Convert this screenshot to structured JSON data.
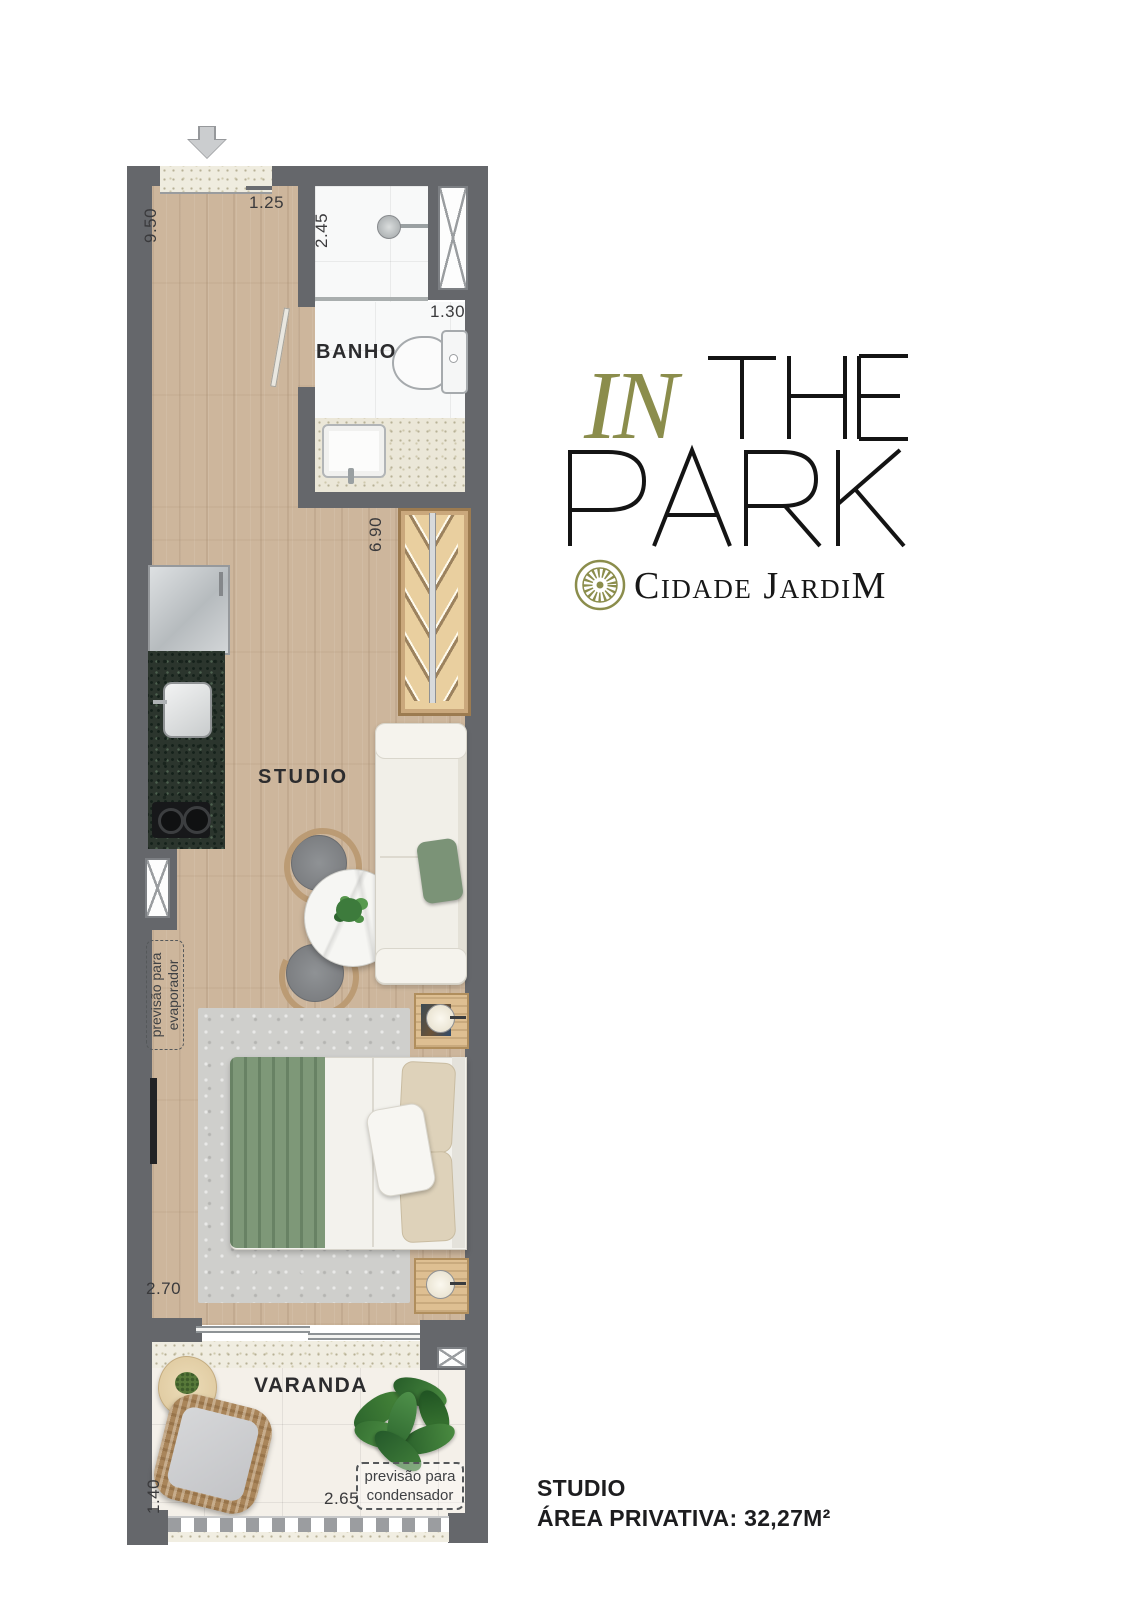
{
  "page": {
    "background": "#ffffff"
  },
  "logo": {
    "in": "IN",
    "the": "THE",
    "park": "PARK",
    "wordmark": "IN THE PARK",
    "brand": "Cidade JardiM",
    "olive_color": "#8b8d4c",
    "black_color": "#1a1a1a",
    "emblem_icon": "rosette-icon"
  },
  "plan": {
    "entry_arrow_icon": "entry-arrow-down",
    "rooms": {
      "bathroom": "BANHO",
      "studio": "STUDIO",
      "balcony": "VARANDA"
    },
    "dimensions": {
      "studio_length": "9.50",
      "entry_width": "1.25",
      "shower_depth": "2.45",
      "bath_width": "1.30",
      "closet_wall": "6.90",
      "bedroom_width": "2.70",
      "balcony_depth": "1.40",
      "balcony_width": "2.65"
    },
    "notes": {
      "evaporator_line1": "previsão para",
      "evaporator_line2": "evaporador",
      "condenser_line1": "previsão para",
      "condenser_line2": "condensador"
    },
    "colors": {
      "wall": "#65676b",
      "wood_floor": "#cdb69c",
      "textile_green": "#7e9878",
      "granite_green": "#2b352d"
    }
  },
  "footer": {
    "unit_type": "STUDIO",
    "private_area": "ÁREA PRIVATIVA: 32,27M²"
  }
}
